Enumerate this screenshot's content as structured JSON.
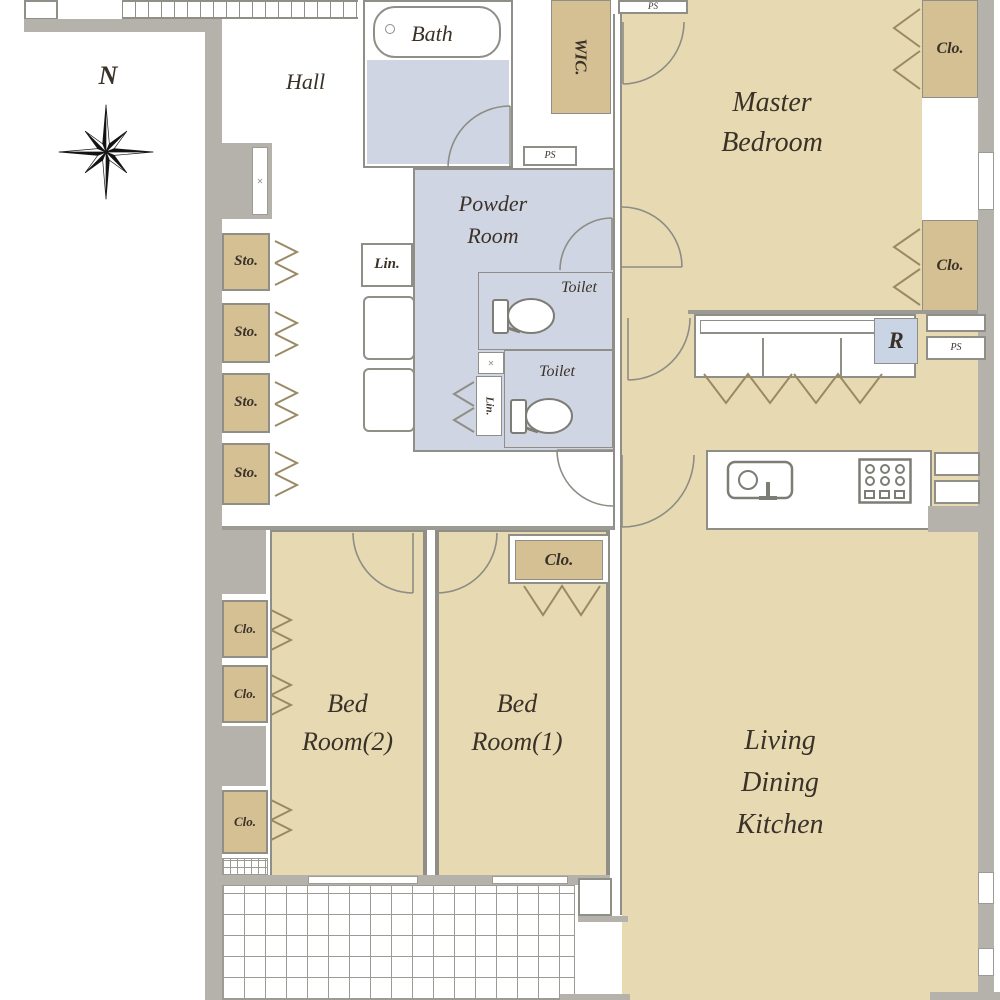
{
  "compass": {
    "north_label": "N"
  },
  "rooms": {
    "hall": {
      "label": "Hall"
    },
    "bath": {
      "label": "Bath"
    },
    "master_bedroom": {
      "line1": "Master",
      "line2": "Bedroom"
    },
    "powder_room": {
      "line1": "Powder",
      "line2": "Room"
    },
    "toilet_upper": {
      "label": "Toilet"
    },
    "toilet_lower": {
      "label": "Toilet"
    },
    "bedroom2": {
      "line1": "Bed",
      "line2": "Room(2)"
    },
    "bedroom1": {
      "line1": "Bed",
      "line2": "Room(1)"
    },
    "ldk": {
      "line1": "Living",
      "line2": "Dining",
      "line3": "Kitchen"
    }
  },
  "storage": {
    "wic_label": "WIC.",
    "sto_label": "Sto.",
    "clo_label": "Clo.",
    "lin_label": "Lin."
  },
  "utilities": {
    "ps_label": "PS",
    "refrigerator_label": "R",
    "x_marker": "✕"
  },
  "icons": {
    "compass-rose": "svg-8-point-star",
    "bathtub": "svg-rounded-rect-with-drain",
    "toilet": "svg-tank-and-bowl",
    "kitchen-sink": "svg-basin-with-faucet",
    "stove": "svg-burner-grid",
    "folding-door": "svg-chevrons",
    "door-swing": "svg-quarter-arc",
    "balcony-floor": "css-grid-hatch"
  },
  "colors": {
    "room_fill": "#e7dab2",
    "closet_fill": "#d5c094",
    "wet_area_fill": "#d0d5e3",
    "wall_fill": "#b5b2ac",
    "line": "#8f8f87",
    "refrigerator_fill": "#c9d4e5",
    "label_text": "#3a3228"
  }
}
